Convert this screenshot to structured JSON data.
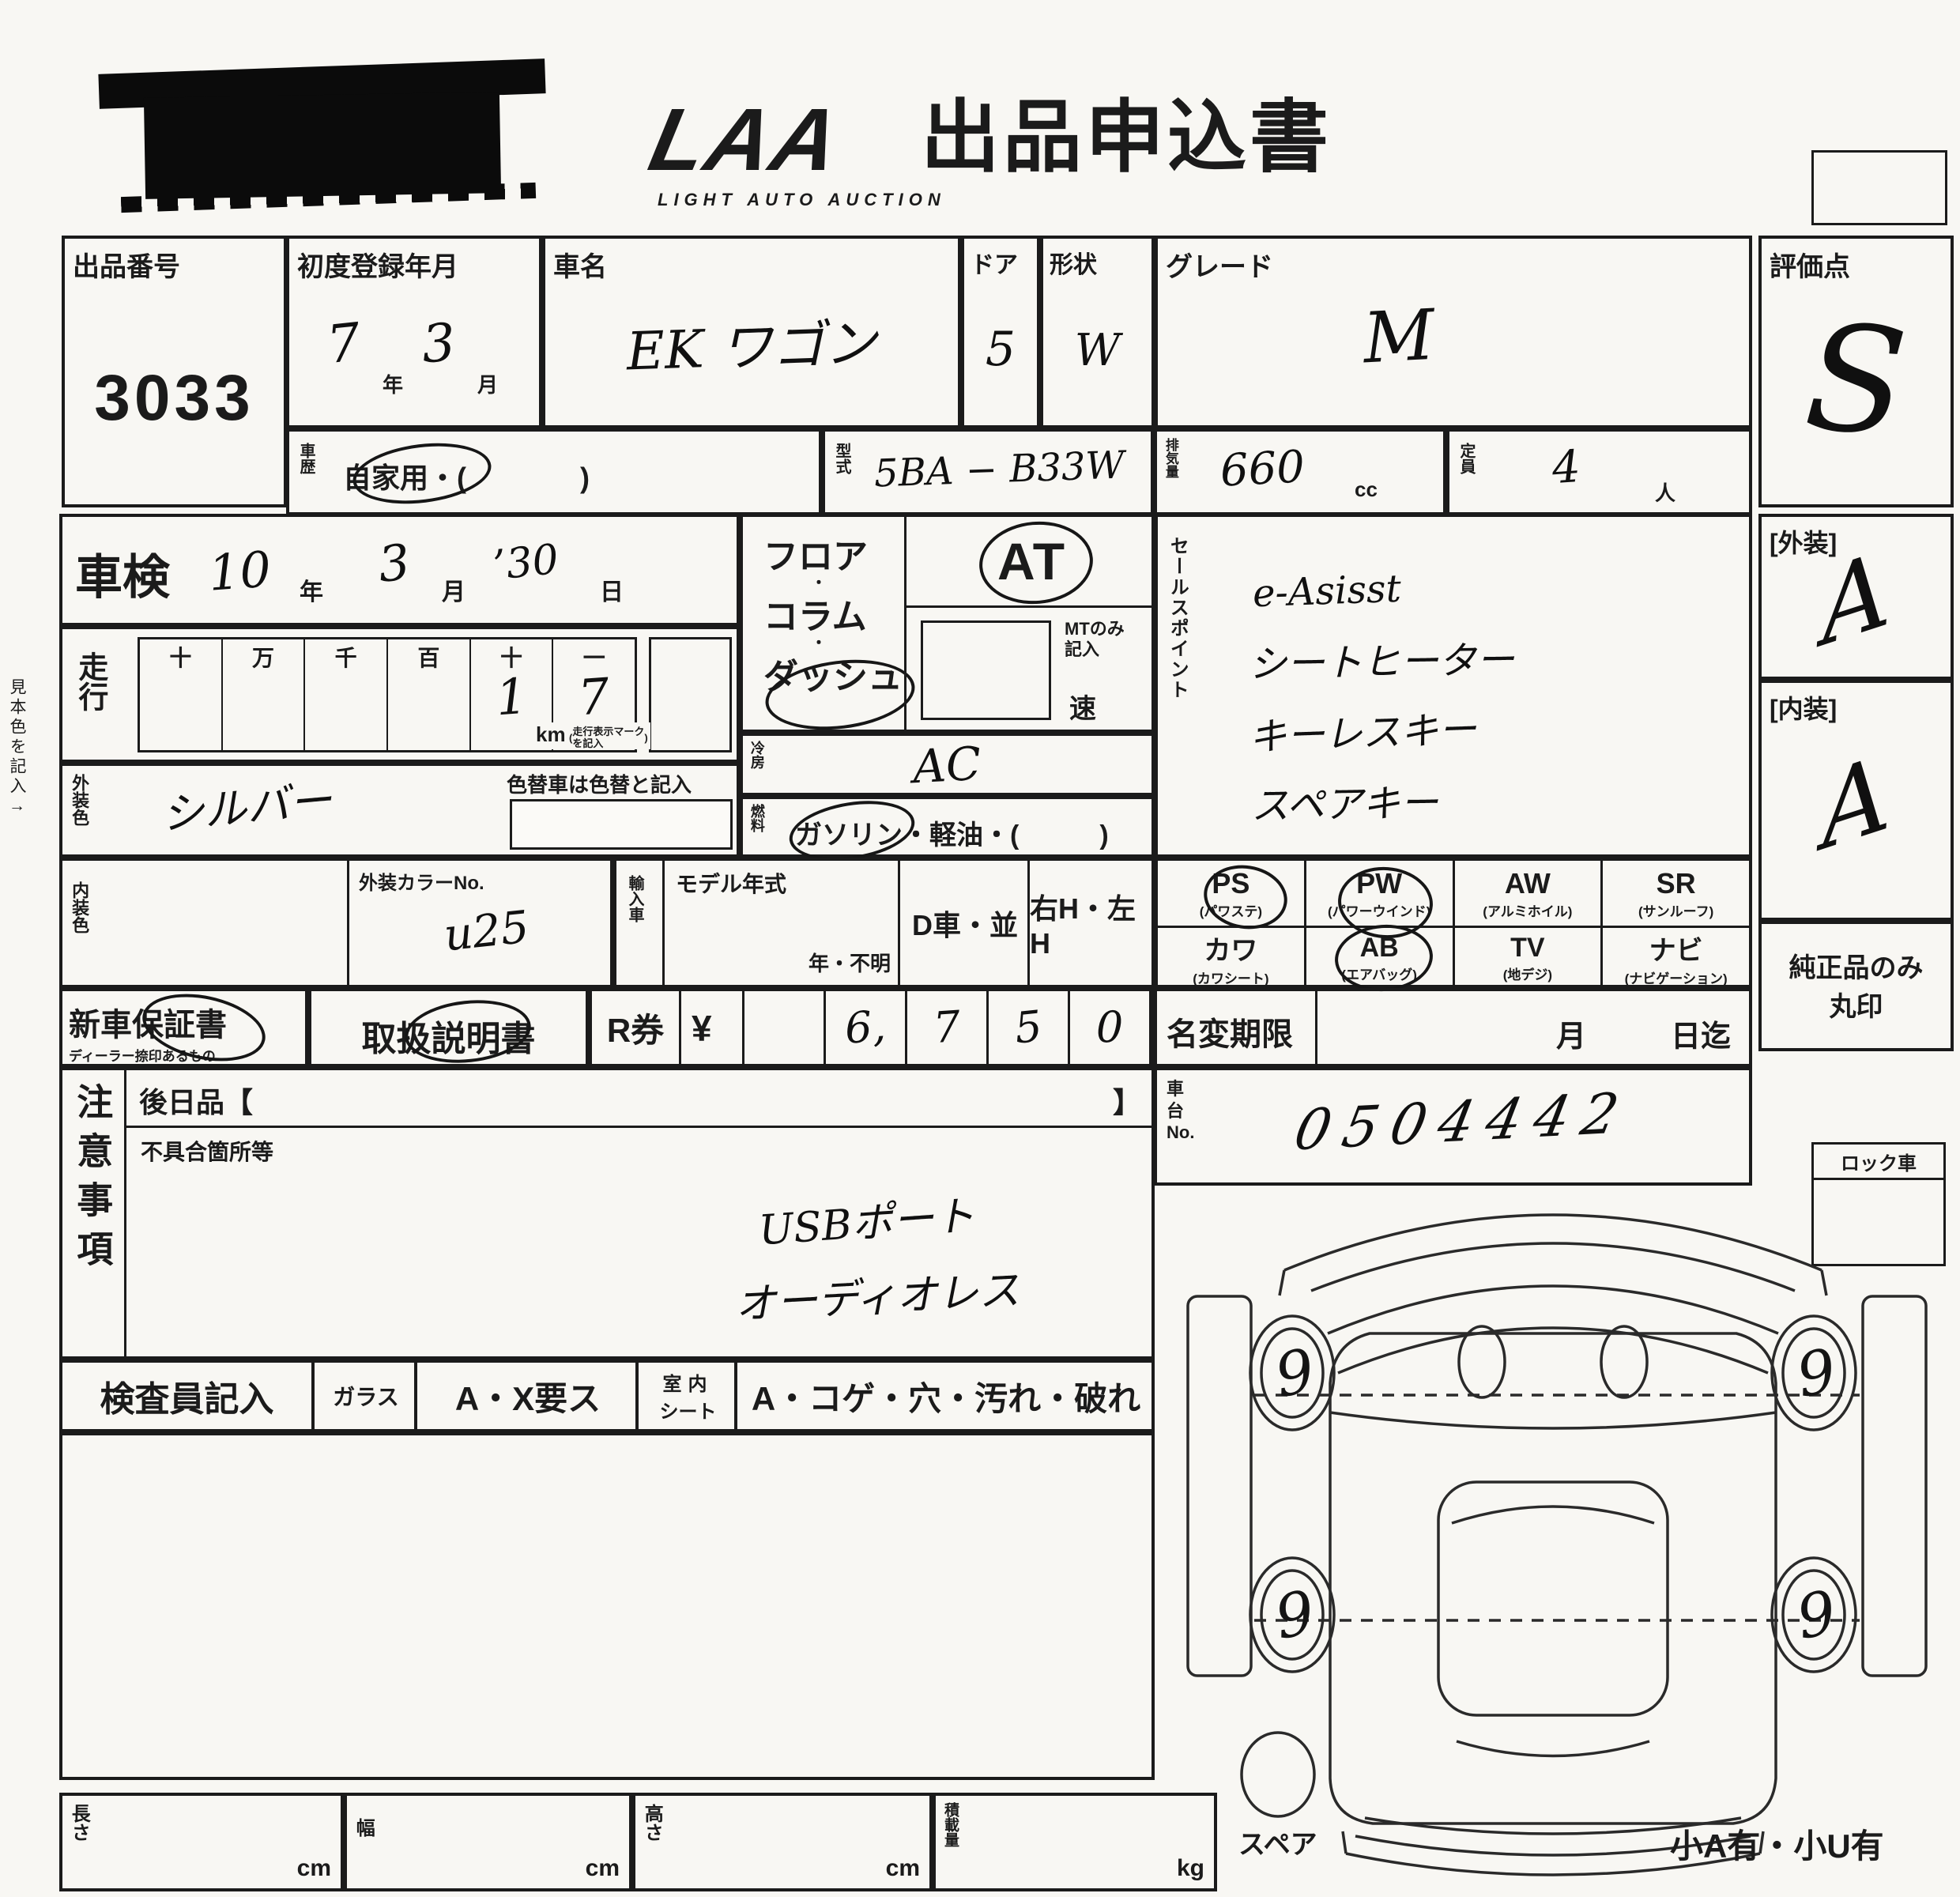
{
  "colors": {
    "paper": "#f8f7f3",
    "ink": "#1b1b1b"
  },
  "header": {
    "logo": "LAA",
    "logo_sub": "LIGHT AUTO AUCTION",
    "title": "出品申込書"
  },
  "top": {
    "lot_label": "出品番号",
    "lot_number": "3033",
    "first_reg_label": "初度登録年月",
    "first_reg_year": "7",
    "year_unit": "年",
    "first_reg_month": "3",
    "month_unit": "月",
    "car_name_label": "車名",
    "car_name": "EK ワゴン",
    "doors_label": "ドア",
    "doors": "5",
    "shape_label": "形状",
    "shape": "W",
    "grade_label": "グレード",
    "grade": "M",
    "score_label": "評価点",
    "score": "S"
  },
  "row2": {
    "history_label": "車歴",
    "history_value": "自家用・(　　　　)",
    "model_code_label": "型式",
    "model_code": "5BA − B33W",
    "displacement_label": "排気量",
    "displacement": "660",
    "cc_unit": "cc",
    "capacity_label": "定員",
    "capacity": "4",
    "nin_unit": "人"
  },
  "shaken": {
    "label": "車検",
    "year": "10",
    "year_unit": "年",
    "month": "3",
    "month_unit": "月",
    "day": "’30",
    "day_unit": "日"
  },
  "mileage": {
    "label": "走行",
    "headers": [
      "十",
      "万",
      "千",
      "百",
      "十",
      "一"
    ],
    "digits": [
      "",
      "",
      "",
      "",
      "1",
      "7"
    ],
    "km": "km",
    "km_note_1": "走行表示マーク",
    "km_note_2": "を記入"
  },
  "shift": {
    "line1": "フロア",
    "dot": "・",
    "line2": "コラム",
    "line3": "ダッシュ",
    "at": "AT",
    "mt_note_1": "MTのみ",
    "mt_note_2": "記入",
    "speed": "速"
  },
  "aircon": {
    "label": "冷房",
    "value": "AC"
  },
  "fuel": {
    "label": "燃料",
    "value": "ガソリン・軽油・(　　　)"
  },
  "ext_color": {
    "label": "外装色",
    "value": "シルバー",
    "repaint_note": "色替車は色替と記入"
  },
  "int_color": {
    "label": "内装色",
    "color_no_label": "外装カラーNo.",
    "color_no": "u25"
  },
  "import_car": {
    "label": "輸入車",
    "model_year_label": "モデル年式",
    "year_unknown": "年・不明",
    "d_car": "D車・並",
    "handle": "右H・左H"
  },
  "sales_points": {
    "label": "セールスポイント",
    "lines": [
      "e-Asisst",
      "シートヒーター",
      "キーレスキー",
      "スペアキー"
    ]
  },
  "equipment": {
    "row1": [
      {
        "code": "PS",
        "sub": "(パワステ)"
      },
      {
        "code": "PW",
        "sub": "(パワーウインド)"
      },
      {
        "code": "AW",
        "sub": "(アルミホイル)"
      },
      {
        "code": "SR",
        "sub": "(サンルーフ)"
      }
    ],
    "row2": [
      {
        "code": "カワ",
        "sub": "(カワシート)"
      },
      {
        "code": "AB",
        "sub": "(エアバッグ)"
      },
      {
        "code": "TV",
        "sub": "(地デジ)"
      },
      {
        "code": "ナビ",
        "sub": "(ナビゲーション)"
      }
    ]
  },
  "ratings": {
    "exterior_label": "[外装]",
    "exterior": "A",
    "interior_label": "[内装]",
    "interior": "A",
    "genuine_1": "純正品のみ",
    "genuine_2": "丸印"
  },
  "warranty": {
    "new_car": "新車保証書",
    "new_car_sub": "ディーラー捺印あるもの",
    "manual": "取扱説明書",
    "r_ticket": "R券",
    "yen": "¥",
    "amount_cells": [
      "",
      "6,",
      "7",
      "5",
      "0"
    ]
  },
  "name_change": {
    "label": "名変期限",
    "month_unit": "月",
    "day_until": "日迄"
  },
  "chassis": {
    "label_1": "車",
    "label_2": "台",
    "label_3": "No.",
    "value": "0504442"
  },
  "notes": {
    "label": "注意事項",
    "later_items": "後日品【",
    "bracket_close": "】",
    "defects_label": "不具合箇所等",
    "hand_lines": [
      "USBポート",
      "オーディオレス"
    ]
  },
  "inspector": {
    "label": "検査員記入",
    "glass_label": "ガラス",
    "glass_value": "A・X要ス",
    "seat_label_top": "室内",
    "seat_label_bottom": "シート",
    "seat_value": "A・コゲ・穴・汚れ・破れ"
  },
  "dimensions": {
    "length_label": "長さ",
    "width_label": "幅",
    "height_label": "高さ",
    "load_label": "積載量",
    "cm": "cm",
    "kg": "kg"
  },
  "diagram": {
    "wheels": [
      "9",
      "9",
      "9",
      "9"
    ],
    "spare_label": "スペア",
    "bottom_right": "小A有・小U有",
    "lock_label": "ロック車"
  },
  "margin_note": "見本色を記入→"
}
